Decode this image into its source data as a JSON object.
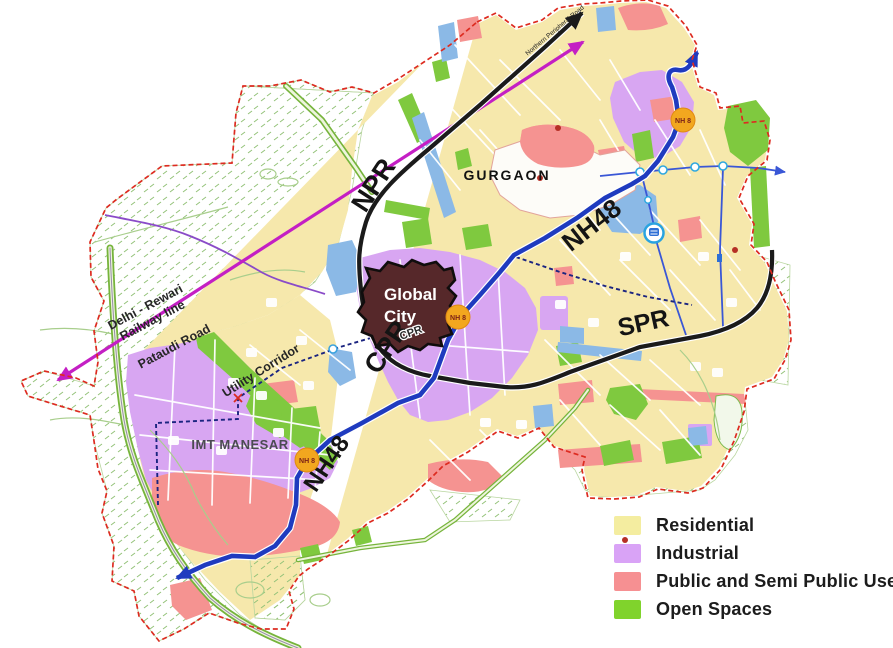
{
  "colors": {
    "res": "#F6E8AC",
    "ind": "#D8A6F2",
    "pub": "#F59391",
    "open": "#7FC93F",
    "water": "#8BB9E6",
    "nh48": "#1F3BBF",
    "road-black": "#1B1B1B",
    "railway": "#C41FC4",
    "boundary": "#DD2B20",
    "metro": "#3A57D6",
    "navy": "#1B2480",
    "green-road": "#79B83C",
    "badge": "#F2A71F",
    "global-city": "#56282A"
  },
  "legend": {
    "items": [
      {
        "label": "Residential",
        "color": "#F4EDA0"
      },
      {
        "label": "Industrial",
        "color": "#D9A3F6"
      },
      {
        "label": "Public and Semi Public Use",
        "color": "#F69092"
      },
      {
        "label": "Open Spaces",
        "color": "#80D32C"
      }
    ]
  },
  "map": {
    "road_labels": {
      "npr": "NPR",
      "npr_full": "Northern Peripheral Road",
      "nh48_upper": "NH48",
      "nh48_lower": "NH48",
      "spr": "SPR",
      "cpr": "CPR",
      "cpr_small": "CPR"
    },
    "place_labels": {
      "gurgaon": "GURGAON",
      "global_city_line1": "Global",
      "global_city_line2": "City",
      "imt": "IMT MANESAR"
    },
    "corridor_labels": {
      "railway_line1": "Delhi - Rewari",
      "railway_line2": "Railway line",
      "pataudi": "Pataudi Road",
      "utility": "Utility Corridor"
    },
    "badges": [
      {
        "label": "NH 8"
      },
      {
        "label": "NH 8"
      },
      {
        "label": "NH 8"
      }
    ]
  }
}
